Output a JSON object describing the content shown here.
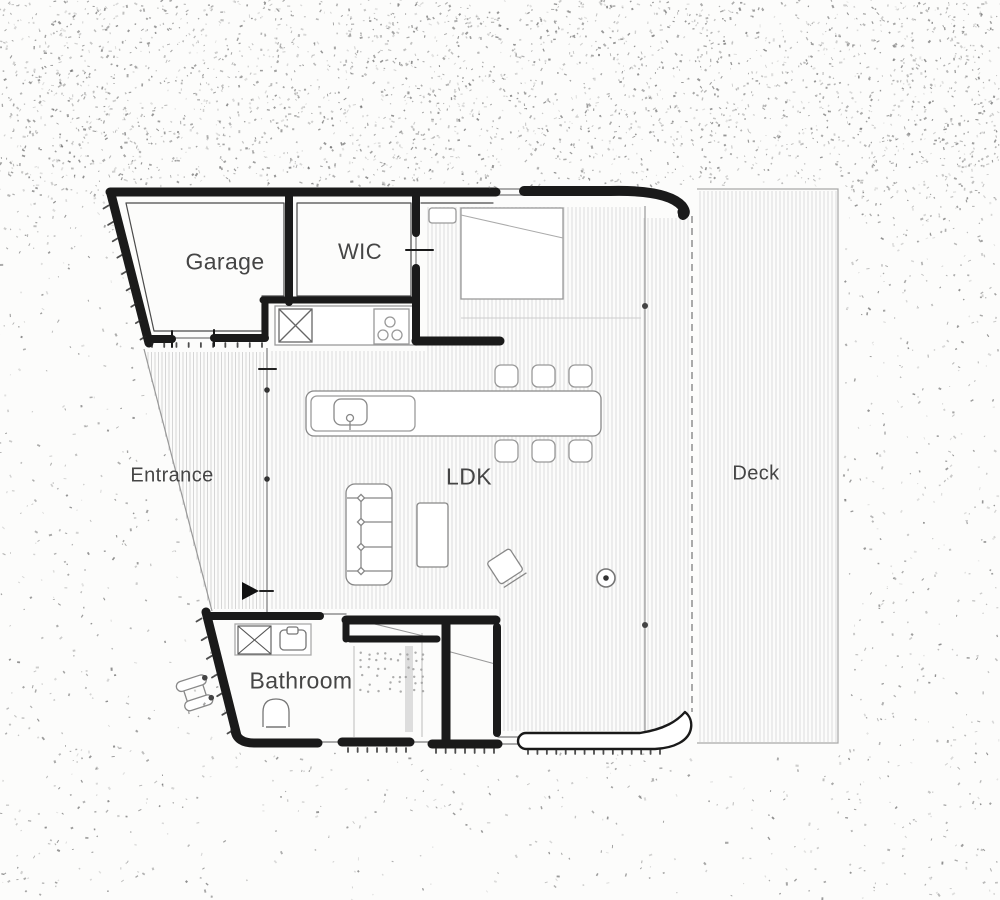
{
  "floor_plan": {
    "rooms": {
      "garage": {
        "label": "Garage"
      },
      "wic": {
        "label": "WIC"
      },
      "entrance": {
        "label": "Entrance"
      },
      "ldk": {
        "label": "LDK"
      },
      "deck": {
        "label": "Deck"
      },
      "bathroom": {
        "label": "Bathroom"
      }
    },
    "colors": {
      "wall": "#1a1a1a",
      "wall_inner": "#4a4a4a",
      "furniture": "#8a8a8a",
      "furniture_dark": "#555555",
      "hatch": "#d7d7d7",
      "hatch_entrance": "#d0d0d0",
      "label": "#454545",
      "speckle": "#5f5f5f",
      "thin": "#999999",
      "dashed": "#8f8f8f",
      "tick": "#222222",
      "background": "#fcfcfb"
    }
  }
}
